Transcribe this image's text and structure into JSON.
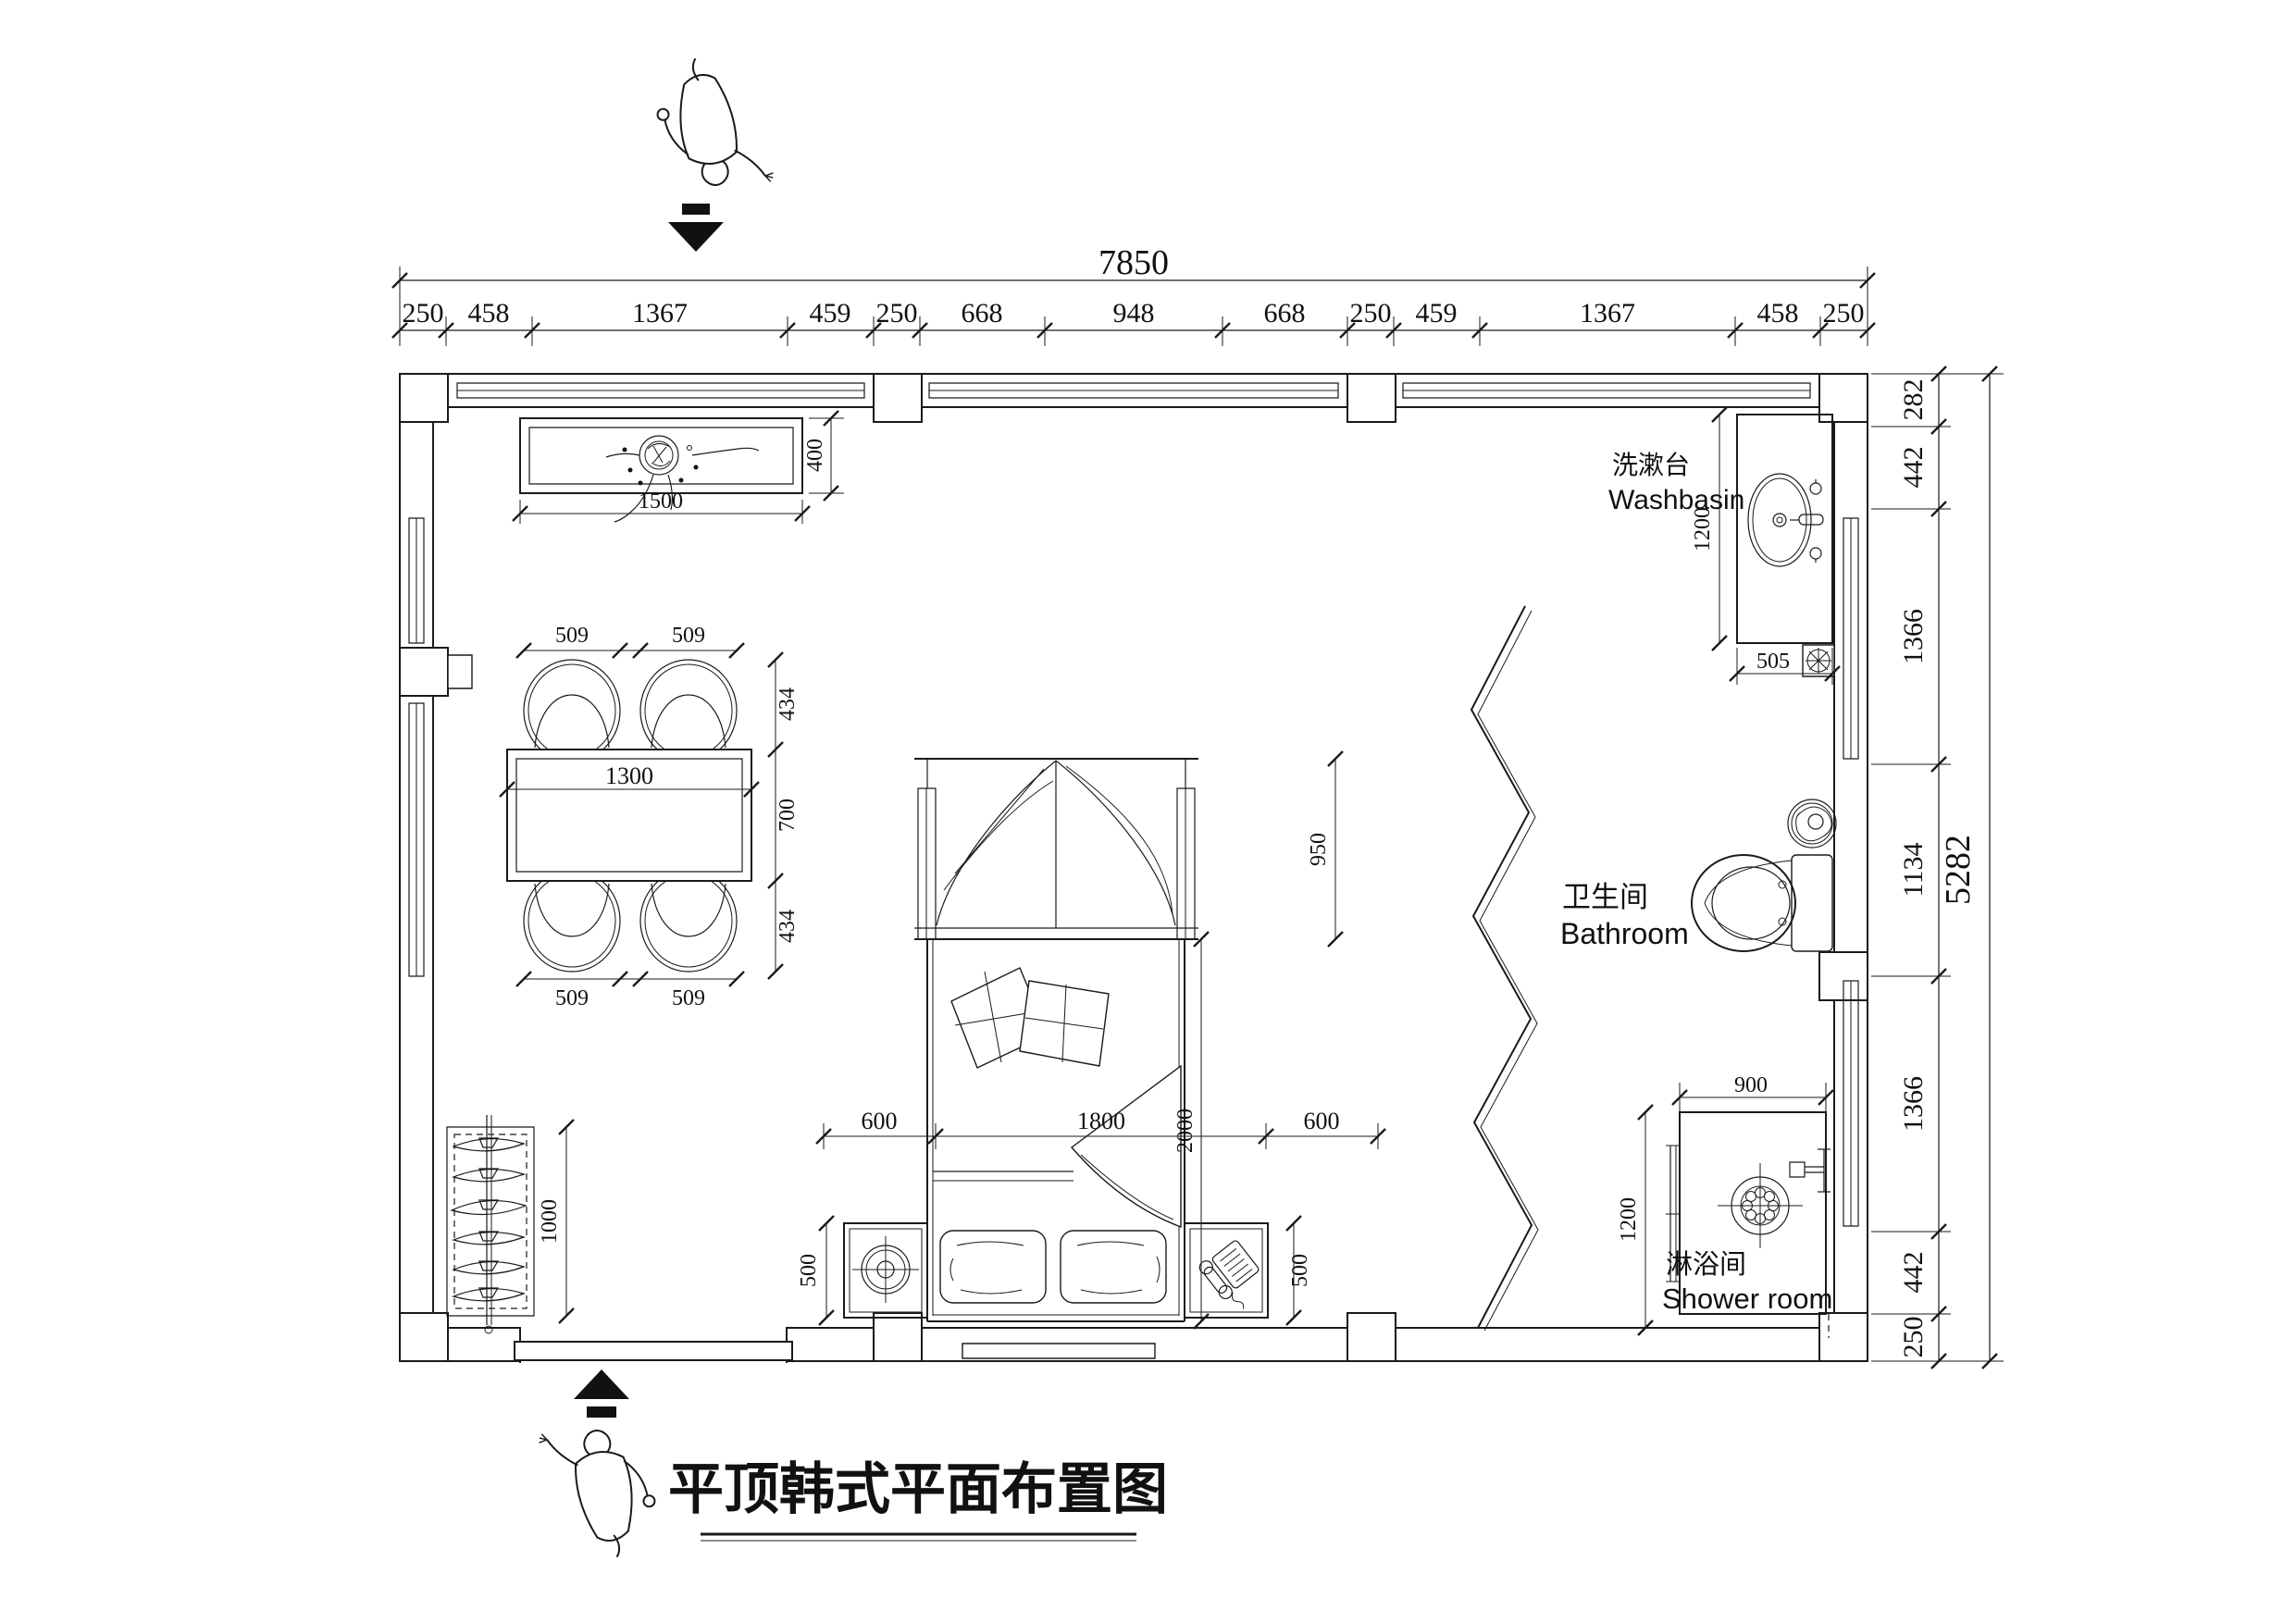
{
  "title": "平顶韩式平面布置图",
  "dims": {
    "top": {
      "total": "7850",
      "segments": [
        "250",
        "458",
        "1367",
        "459",
        "250",
        "668",
        "948",
        "668",
        "250",
        "459",
        "1367",
        "458",
        "250"
      ]
    },
    "right": {
      "total": "5282",
      "segments": [
        "282",
        "442",
        "1366",
        "1134",
        "1366",
        "442",
        "250"
      ]
    }
  },
  "rooms": {
    "washbasin": {
      "label_zh": "洗漱台",
      "label_en": "Washbasin",
      "depth": "1200",
      "width": "505"
    },
    "bathroom": {
      "label_zh": "卫生间",
      "label_en": "Bathroom"
    },
    "shower": {
      "label_zh": "淋浴间",
      "label_en": "Shower room",
      "width": "900",
      "depth": "1200"
    }
  },
  "furniture": {
    "counter": {
      "width": "1500",
      "depth": "400"
    },
    "dining": {
      "chair_width": "509",
      "side_depth": "434",
      "table_depth": "700",
      "table_width": "1300"
    },
    "rack": {
      "length": "1000"
    },
    "bed": {
      "side": "600",
      "width": "1800",
      "canopy_depth": "950",
      "length": "2000",
      "nightstand_depth": "500"
    }
  },
  "colors": {
    "ink": "#1a1a1a",
    "paper": "#ffffff"
  }
}
